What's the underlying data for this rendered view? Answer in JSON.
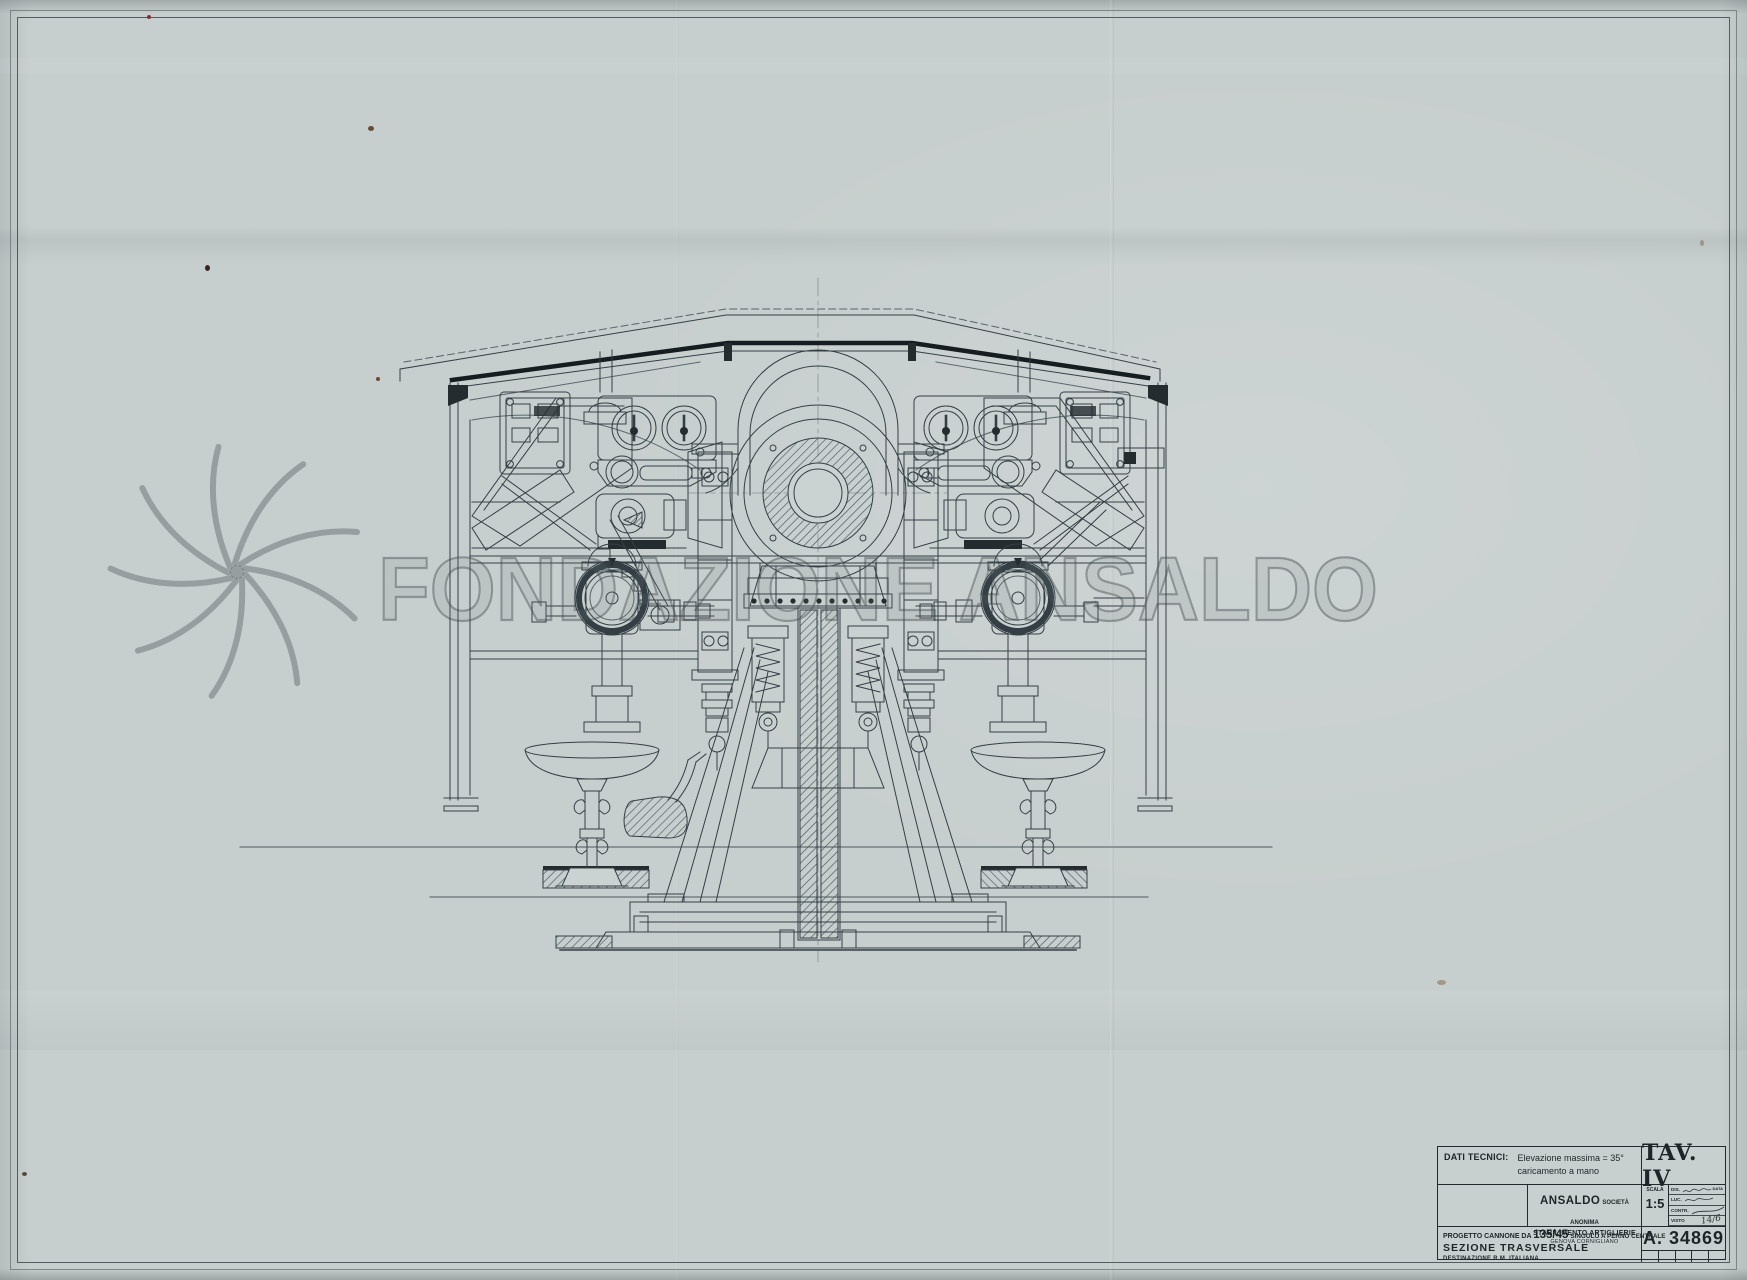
{
  "watermark": {
    "text": "FONDAZIONE ANSALDO"
  },
  "title_block": {
    "dati_tecnici_label": "DATI TECNICI:",
    "dati_lines": [
      "Elevazione massima = 35°",
      "caricamento a mano"
    ],
    "tav_label": "TAV. IV",
    "company": {
      "name": "ANSALDO",
      "type": "SOCIETÀ ANONIMA",
      "line2": "STABILIMENTO ARTIGLIERIE",
      "line3": "GENOVA CORNIGLIANO"
    },
    "scala_label": "SCALA",
    "scala_value": "1:5",
    "data_header": "DATA",
    "approvals": [
      {
        "label": "DIS."
      },
      {
        "label": "LUC."
      },
      {
        "label": "CONTR."
      },
      {
        "label": "VISTO",
        "value": "14/6"
      }
    ],
    "project": {
      "prefix": "PROGETTO CANNONE DA",
      "caliber": "135/45",
      "suffix": "SINGOLO A PERNO CENTRALE",
      "line2": "SEZIONE TRASVERSALE",
      "line3": "DESTINAZIONE  R.M. ITALIANA"
    },
    "drawing_number": "A. 34869"
  }
}
